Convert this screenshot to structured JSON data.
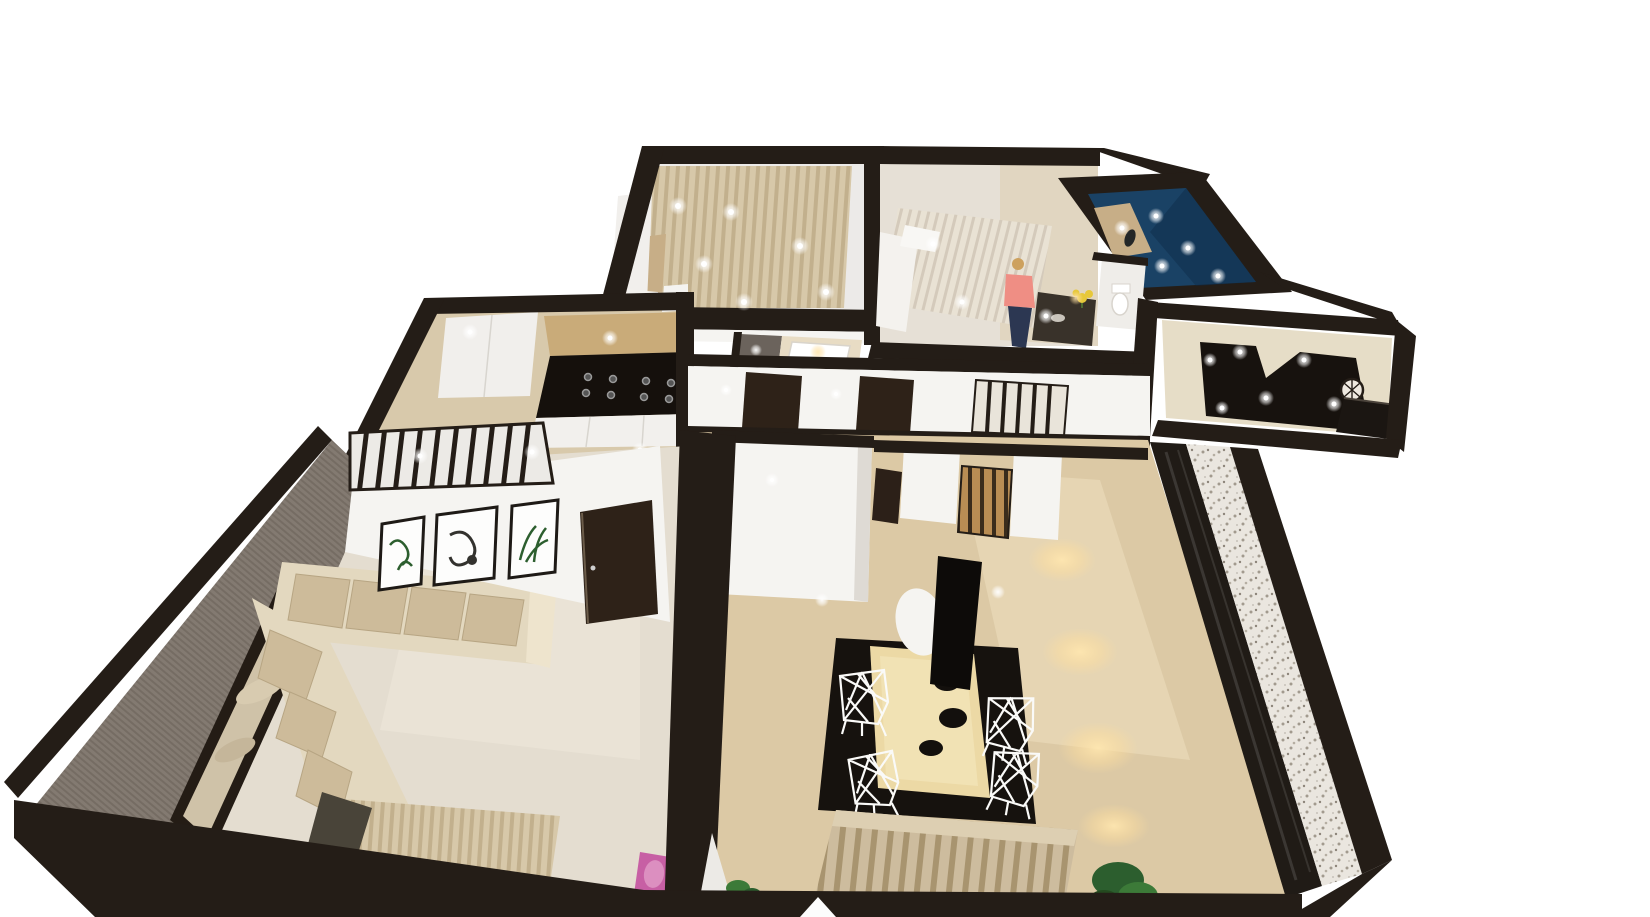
{
  "meta": {
    "type": "3d-floorplan-render",
    "description": "Axonometric dollhouse view of a furnished apartment, white background",
    "background": "#ffffff"
  },
  "palette": {
    "wall": "#241d17",
    "wall_face": "#f5f4f1",
    "wall_face_shade": "#dedad4",
    "floor_light": "#e4ddd0",
    "floor_pale": "#eceae8",
    "floor_wood": "#d8c9ab",
    "floor_wood_warm": "#dcc9a5",
    "floor_dark": "#17120e",
    "hall_floor": "#e6ddc7",
    "curtain": "#d7c8a9",
    "sofa_base": "#e3d8bf",
    "sofa_cushion": "#cdbb9a",
    "sofa_arm": "#eee4cd",
    "throw_dark": "#494439",
    "gray_wall": "#837a71",
    "mirror_frame": "#241c15",
    "mirror_glass": "#cfc2a8",
    "closet_blue": "#1a4265",
    "closet_shelf_tan": "#c7ae87",
    "door": "#2e2218",
    "door_jamb": "#2c2018",
    "counter_wood": "#c9ab79",
    "cooktop": "#15100c",
    "cabinet_white": "#f2f0ed",
    "fridge_white": "#f1efec",
    "table_wood": "#ecd9a5",
    "rug": "#16120e",
    "bench_white": "#f6f4f0",
    "lamp_white": "#f5f4f1",
    "pendant_black": "#0d0b09",
    "glass_dark": "#201b16",
    "counter_dark": "#39322a",
    "gray_cell": "#6b635c",
    "tub_warm": "#e8dcc4",
    "person_hair": "#cda15e",
    "person_top": "#ef8e84",
    "person_jeans": "#2c3752",
    "pink_accent": "#c75fa4",
    "pink_light": "#dc8fc0",
    "plant_green": "#2c5e2e",
    "plant_green_light": "#3c7a38",
    "flower_yellow": "#e7c83a",
    "white_panel": "#eceae6",
    "marker_white": "#fcfcfc",
    "clock_face": "#efe9e0",
    "wardrobe_white": "#f1efec",
    "bed_head_white": "#f4f2ee"
  },
  "scene": {
    "rooms": [
      {
        "id": "bedroom-curtains",
        "label": "Bedroom with curtain wall"
      },
      {
        "id": "bedroom-second",
        "label": "Second bedroom with person"
      },
      {
        "id": "walk-in-closet",
        "label": "Walk-in closet (navy)"
      },
      {
        "id": "wc",
        "label": "WC"
      },
      {
        "id": "entry-hall",
        "label": "Entry hall with dark floor"
      },
      {
        "id": "bathroom",
        "label": "Bathroom with tub"
      },
      {
        "id": "kitchen",
        "label": "Kitchen"
      },
      {
        "id": "corridor",
        "label": "Corridor"
      },
      {
        "id": "living-room",
        "label": "Living room"
      },
      {
        "id": "dining-room",
        "label": "Dining room"
      }
    ],
    "furniture": [
      "curtain-wall",
      "wardrobe",
      "dresser",
      "double-bed",
      "kitchenette-counter",
      "flower-vase",
      "person-figure",
      "blue-wardrobe",
      "toilet",
      "console-table",
      "wall-clock",
      "fridge-cabinet",
      "gas-cooktop",
      "kitchen-counter",
      "slatted-partition",
      "framed-prints",
      "interior-door",
      "sectional-sofa",
      "wall-mirror",
      "gray-accent-wall",
      "pleated-curtain",
      "pink-cushion",
      "dining-table",
      "wire-chairs",
      "black-rug",
      "pendant-lamp",
      "white-lamp",
      "bench",
      "second-sofa",
      "wood-slat-screen",
      "potted-plant",
      "bathtub",
      "downlights"
    ],
    "controls": {
      "rotate_marker": "white triangle handle at bottom edge"
    }
  }
}
